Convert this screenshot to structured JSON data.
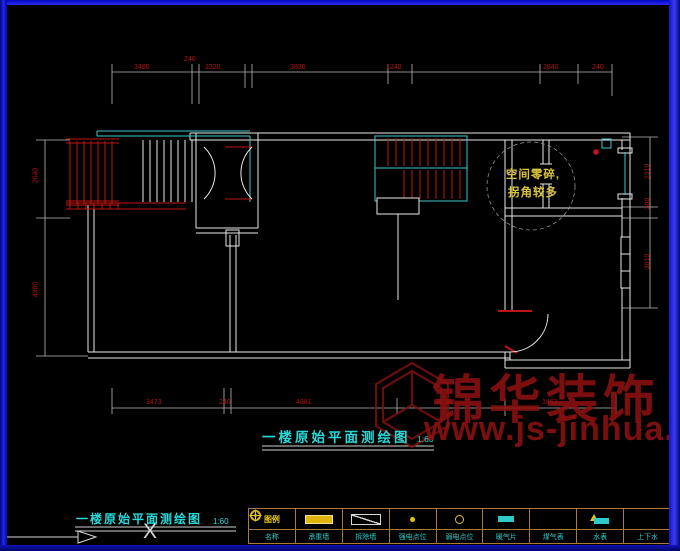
{
  "titles": {
    "main": {
      "text": "一楼原始平面测绘图",
      "scale": "1:60"
    },
    "secondary": {
      "text": "一楼原始平面测绘图",
      "scale": "1:60"
    }
  },
  "annotation_note": {
    "line1": "空间零碎,",
    "line2": "拐角较多"
  },
  "watermark": {
    "brand": "锦华装饰",
    "url": "www.js-jinhua.com"
  },
  "ucs_icon": {
    "axis_label": "X"
  },
  "dimensions": {
    "top": [
      {
        "t": "3460"
      },
      {
        "t": "240"
      },
      {
        "t": "1520"
      },
      {
        "t": "3836"
      },
      {
        "t": "1240"
      },
      {
        "t": "2840"
      },
      {
        "t": "240"
      }
    ],
    "bottom": [
      {
        "t": "3473"
      },
      {
        "t": "240"
      },
      {
        "t": "4881"
      },
      {
        "t": "3154"
      },
      {
        "t": "1462"
      }
    ],
    "left": [
      {
        "t": "2040"
      },
      {
        "t": "4380"
      }
    ],
    "right": [
      {
        "t": "2310"
      },
      {
        "t": "300"
      },
      {
        "t": "3010"
      }
    ]
  },
  "legend": {
    "header": "图例",
    "cells": [
      {
        "icon": "name",
        "label": "名称"
      },
      {
        "icon": "wall-solid",
        "label": "承重墙"
      },
      {
        "icon": "wall-removed",
        "label": "拆除墙"
      },
      {
        "icon": "power-point",
        "label": "强电点位"
      },
      {
        "icon": "weak-point",
        "label": "弱电点位"
      },
      {
        "icon": "radiator",
        "label": "暖气片"
      },
      {
        "icon": "gas-meter",
        "label": "煤气表"
      },
      {
        "icon": "water-meter",
        "label": "水表"
      },
      {
        "icon": "drain",
        "label": "上下水"
      }
    ]
  },
  "colors": {
    "wall": "#e8e8e8",
    "cad_cyan": "#3ec7c7",
    "cad_red": "#c01414",
    "dim_text": "#b51212",
    "title_cyan": "#28d8d8",
    "legend_grid": "#a87b3c",
    "legend_label": "#2fc9c9",
    "icon_yellow": "#e4c414",
    "watermark_red": "#8c1212",
    "annotation_yellow": "#d8c33c",
    "frame_blue": "#2525ea"
  }
}
